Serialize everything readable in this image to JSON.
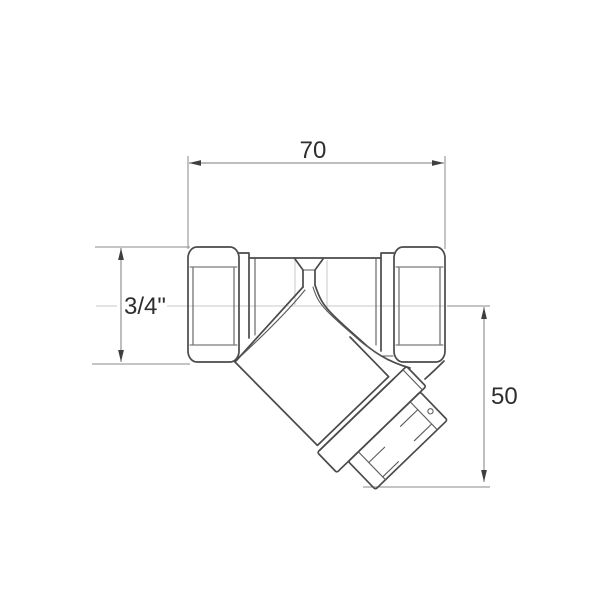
{
  "drawing": {
    "subject": "y-strainer-valve-side-view",
    "dimensions": {
      "width_label": "70",
      "thread_label": "3/4\"",
      "height_label": "50"
    },
    "colors": {
      "background": "#ffffff",
      "outline": "#4a4a4a",
      "detail_line": "#5a5a5a",
      "dimension_line": "#7d7d7d",
      "centerline": "#c9c9c9",
      "arrow": "#3f3f3f",
      "text": "#2e2e2e"
    }
  }
}
